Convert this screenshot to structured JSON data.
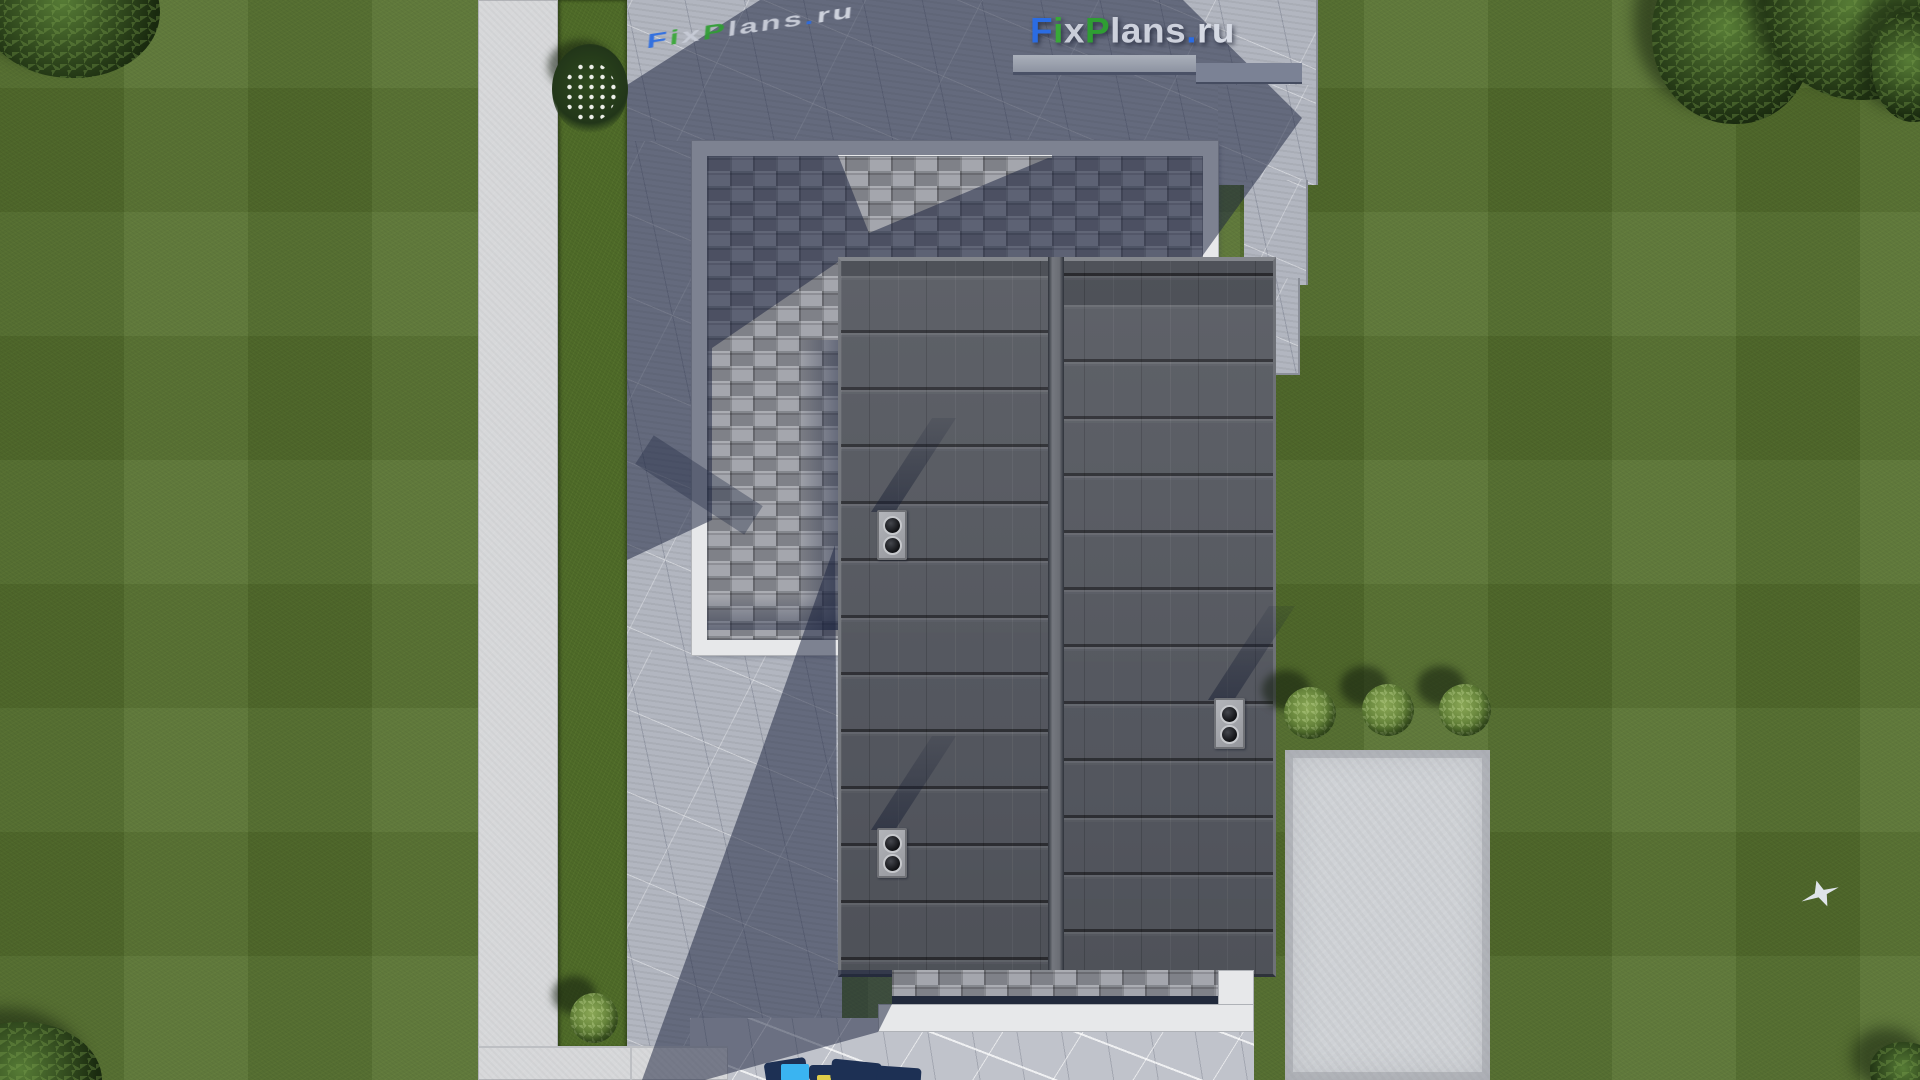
{
  "watermarks": {
    "main_logo": {
      "full_text": "FixPlans.ru",
      "parts": [
        {
          "text": "F",
          "color": "#2b6ce2"
        },
        {
          "text": "i",
          "color": "#38a837"
        },
        {
          "text": "x",
          "color": "#c9cdd8"
        },
        {
          "text": "P",
          "color": "#2f9e33"
        },
        {
          "text": "lans",
          "color": "#cdd1dc"
        },
        {
          "text": ".",
          "color": "#2b6ce2"
        },
        {
          "text": "ru",
          "color": "#d6dae4"
        }
      ]
    },
    "ground_logo_text": "FixPlans.ru"
  },
  "colors": {
    "grass": "#55702e",
    "grass_strip": "#4e6a28",
    "concrete_path": "#d7d8da",
    "marble_pavement": "#b2b6c0",
    "marble_pavement_lit": "#c0c3cb",
    "driveway": "#cfd2d6",
    "roof_metal": "#54575f",
    "roof_seam_dark": "#2e323a",
    "shingle": "#979aa2",
    "white_trim": "#e7e8ea",
    "cast_shadow": "rgba(28,36,63,0.52)",
    "logo_blue": "#2b6ce2",
    "logo_green": "#2f9e33",
    "logo_silver": "#cdd1dc",
    "foliage_dark": "#2d471d",
    "foliage_light": "#8aa756",
    "bottom_logo_navy": "#1d3054",
    "bottom_logo_cyan": "#3ab4f1",
    "bottom_logo_yellow": "#e0cc49"
  }
}
